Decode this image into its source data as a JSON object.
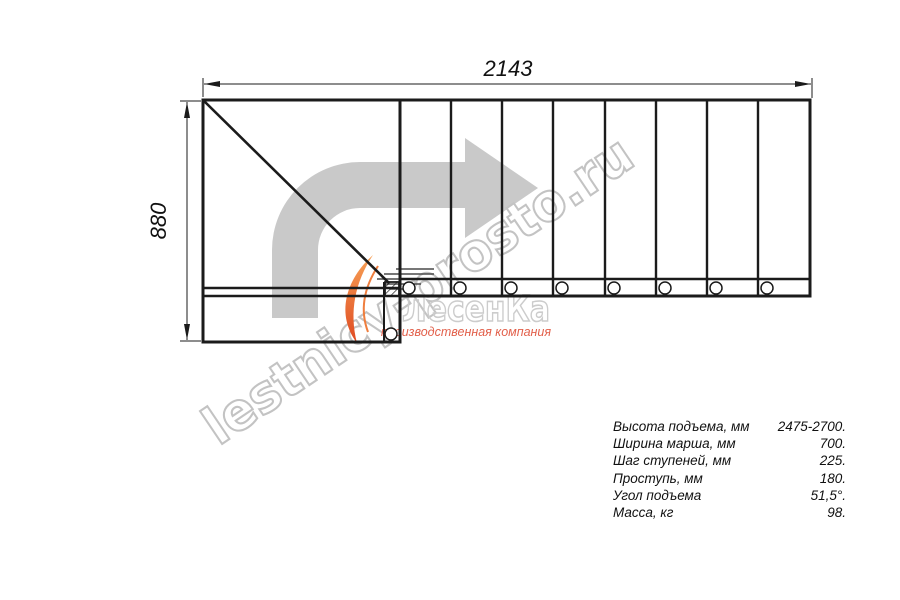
{
  "drawing": {
    "title_semantic": "L-shaped staircase plan view",
    "dimension_top": "2143",
    "dimension_left": "880",
    "line_color": "#1b1b1b"
  },
  "watermark": {
    "diagonal_text": "lestnicy-prosto.ru",
    "logo_title": "ЛесенКа",
    "logo_subtitle": "производственная компания",
    "arrow_icon": "bent-right-arrow",
    "steps_icon": "stair-steps-lines",
    "arrow_color": "#c9c9c9",
    "outline_color": "#c3c3c3",
    "logo_accent_color": "#ee6a36",
    "subtitle_color": "#e2604b"
  },
  "specs": {
    "rows": [
      {
        "label": "Высота подъема, мм",
        "value": "2475-2700."
      },
      {
        "label": "Ширина марша, мм",
        "value": "700."
      },
      {
        "label": "Шаг ступеней, мм",
        "value": "225."
      },
      {
        "label": "Проступь, мм",
        "value": "180."
      },
      {
        "label": "Угол подъема",
        "value": "51,5°."
      },
      {
        "label": "Масса, кг",
        "value": "98."
      }
    ]
  }
}
